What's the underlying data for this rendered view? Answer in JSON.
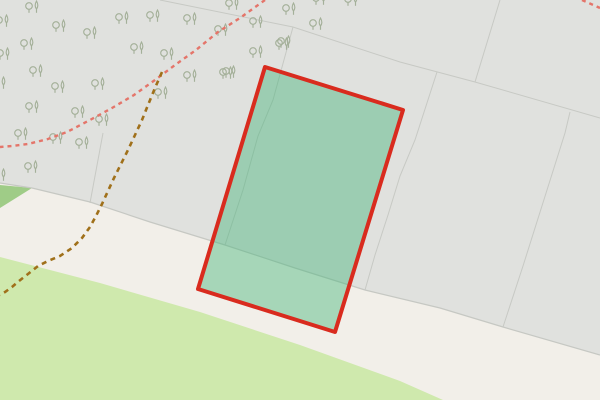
{
  "map": {
    "description": "map-viewport",
    "colors": {
      "ground_beige": "#f2efe9",
      "area_gray": "#e0e1de",
      "grass_green": "#cfe9ad",
      "green_patch": "#9fcc87",
      "boundary_gray": "#c7c9c4",
      "tree_glyph": "#a4b099",
      "footpath_red": "#e4756a",
      "track_brown": "#a0701a",
      "highlight_stroke": "#d92b1e",
      "highlight_fill": "#3db374",
      "highlight_fill_opacity": 0.42
    },
    "regions": [
      {
        "name": "wooded-gray-area",
        "fill": "#e0e1de",
        "points": "0,0 600,0 600,355 503,327 440,308 365,290 295,268 225,245 150,222 90,202 32,188 0,183"
      },
      {
        "name": "green-patch-area",
        "fill": "#9fcc87",
        "points": "0,185 32,188 0,208"
      },
      {
        "name": "grass-area",
        "fill": "#cfe9ad",
        "points": "0,257 100,283 200,312 300,345 400,381 443,400 0,400"
      }
    ],
    "area_edge": {
      "name": "gray-area-edge-line",
      "points": "0,183 32,188 90,202 150,222 225,245 295,268 365,290 440,308 503,327 600,355",
      "stroke": "#c6c8c3",
      "width": 1.2
    },
    "parcel_lines": {
      "stroke": "#c7c9c4",
      "width": 1,
      "lines": [
        {
          "points": "160,0 293,27 400,62 475,82 600,118"
        },
        {
          "points": "500,0 475,82"
        },
        {
          "points": "293,27 273,100 258,136 243,190 225,245"
        },
        {
          "points": "437,72 415,140 400,176 388,215 375,255 365,290"
        },
        {
          "points": "570,112 565,133 523,266 503,327"
        },
        {
          "points": "103,133 90,203"
        }
      ]
    },
    "trees": {
      "glyph": "deciduous-and-conifer-pair",
      "positions": [
        [
          33,
          10
        ],
        [
          123,
          21
        ],
        [
          154,
          19
        ],
        [
          191,
          22
        ],
        [
          3,
          24
        ],
        [
          60,
          29
        ],
        [
          91,
          36
        ],
        [
          28,
          47
        ],
        [
          138,
          51
        ],
        [
          168,
          57
        ],
        [
          4,
          57
        ],
        [
          0,
          86
        ],
        [
          37,
          74
        ],
        [
          59,
          90
        ],
        [
          99,
          87
        ],
        [
          162,
          96
        ],
        [
          191,
          79
        ],
        [
          33,
          110
        ],
        [
          79,
          115
        ],
        [
          103,
          123
        ],
        [
          22,
          137
        ],
        [
          57,
          141
        ],
        [
          83,
          146
        ],
        [
          32,
          170
        ],
        [
          0,
          178
        ],
        [
          233,
          7
        ],
        [
          290,
          12
        ],
        [
          320,
          2
        ],
        [
          352,
          3
        ],
        [
          257,
          25
        ],
        [
          317,
          27
        ],
        [
          222,
          33
        ],
        [
          283,
          47
        ],
        [
          257,
          55
        ],
        [
          227,
          76
        ],
        [
          230,
          75
        ],
        [
          285,
          45
        ]
      ]
    },
    "paths": [
      {
        "name": "footpath-red-dashed",
        "points": "265,0 240,18 218,32 196,50 175,65 155,80 134,95 112,108 90,120 67,132 48,139 28,144 12,146 0,147",
        "stroke": "#e4756a",
        "width": 2.4,
        "dash": "4 4"
      },
      {
        "name": "footpath-red-dashed-corner",
        "points": "582,0 600,8",
        "stroke": "#e4756a",
        "width": 2.4,
        "dash": "4 4"
      },
      {
        "name": "track-brown-dashed",
        "points": "162,72 155,88 148,105 142,120 135,135 128,150 121,164 114,178 108,191 102,204 96,216 90,227 82,238 72,248 60,256 48,261 38,266 28,274 19,281 12,287 5,292 0,295",
        "stroke": "#a0701a",
        "width": 2.6,
        "dash": "5 4.5"
      }
    ],
    "highlight": {
      "name": "selected-parcel-polygon",
      "points": "265,67 403,110 335,332 198,289",
      "stroke": "#d92b1e",
      "stroke_width": 4,
      "fill": "#3db374",
      "fill_opacity": 0.42
    }
  }
}
